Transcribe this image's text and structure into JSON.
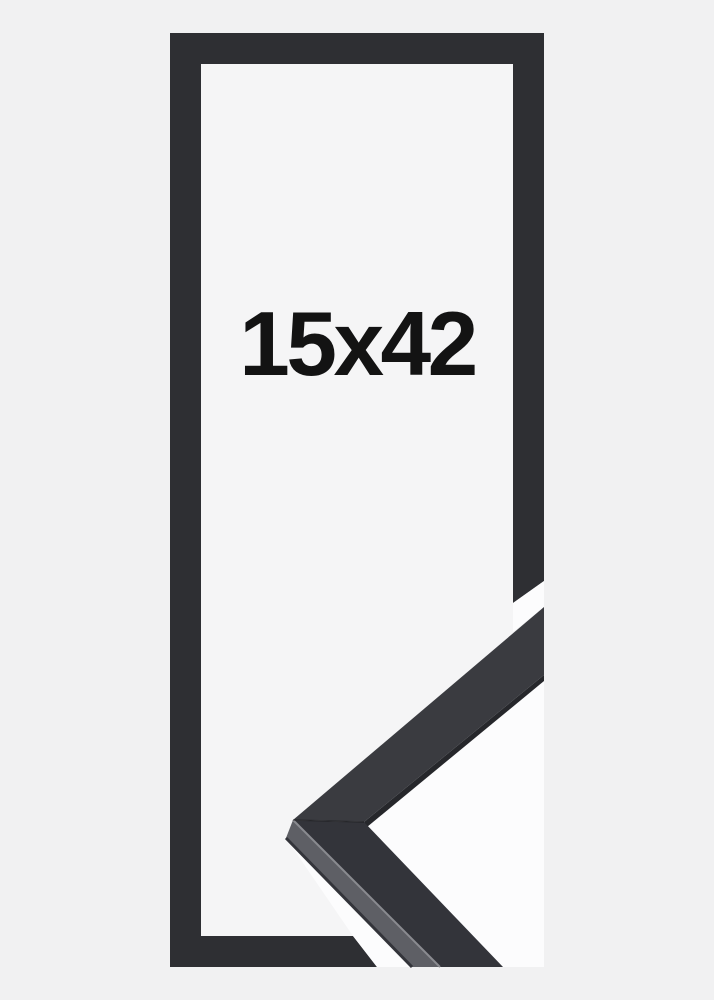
{
  "page": {
    "background": "#f1f1f2"
  },
  "product_photo": {
    "alt": "Black wooden picture frame shown from the front with a mitred corner profile sample overlapping the bottom right",
    "size_label": "15x42",
    "colors": {
      "frame_bar": "#2e2f33",
      "frame_interior": "#f5f5f6",
      "photo_backdrop": "#fcfcfd",
      "moulding_face_upper": "#3a3b40",
      "moulding_face_lower": "#33343a",
      "moulding_side": "#5e5f65",
      "moulding_edge_dark": "#26272b",
      "moulding_arris_highlight": "#8a8b90",
      "moulding_seam": "rgba(18,18,20,0.45)",
      "label_text": "#131313"
    }
  }
}
